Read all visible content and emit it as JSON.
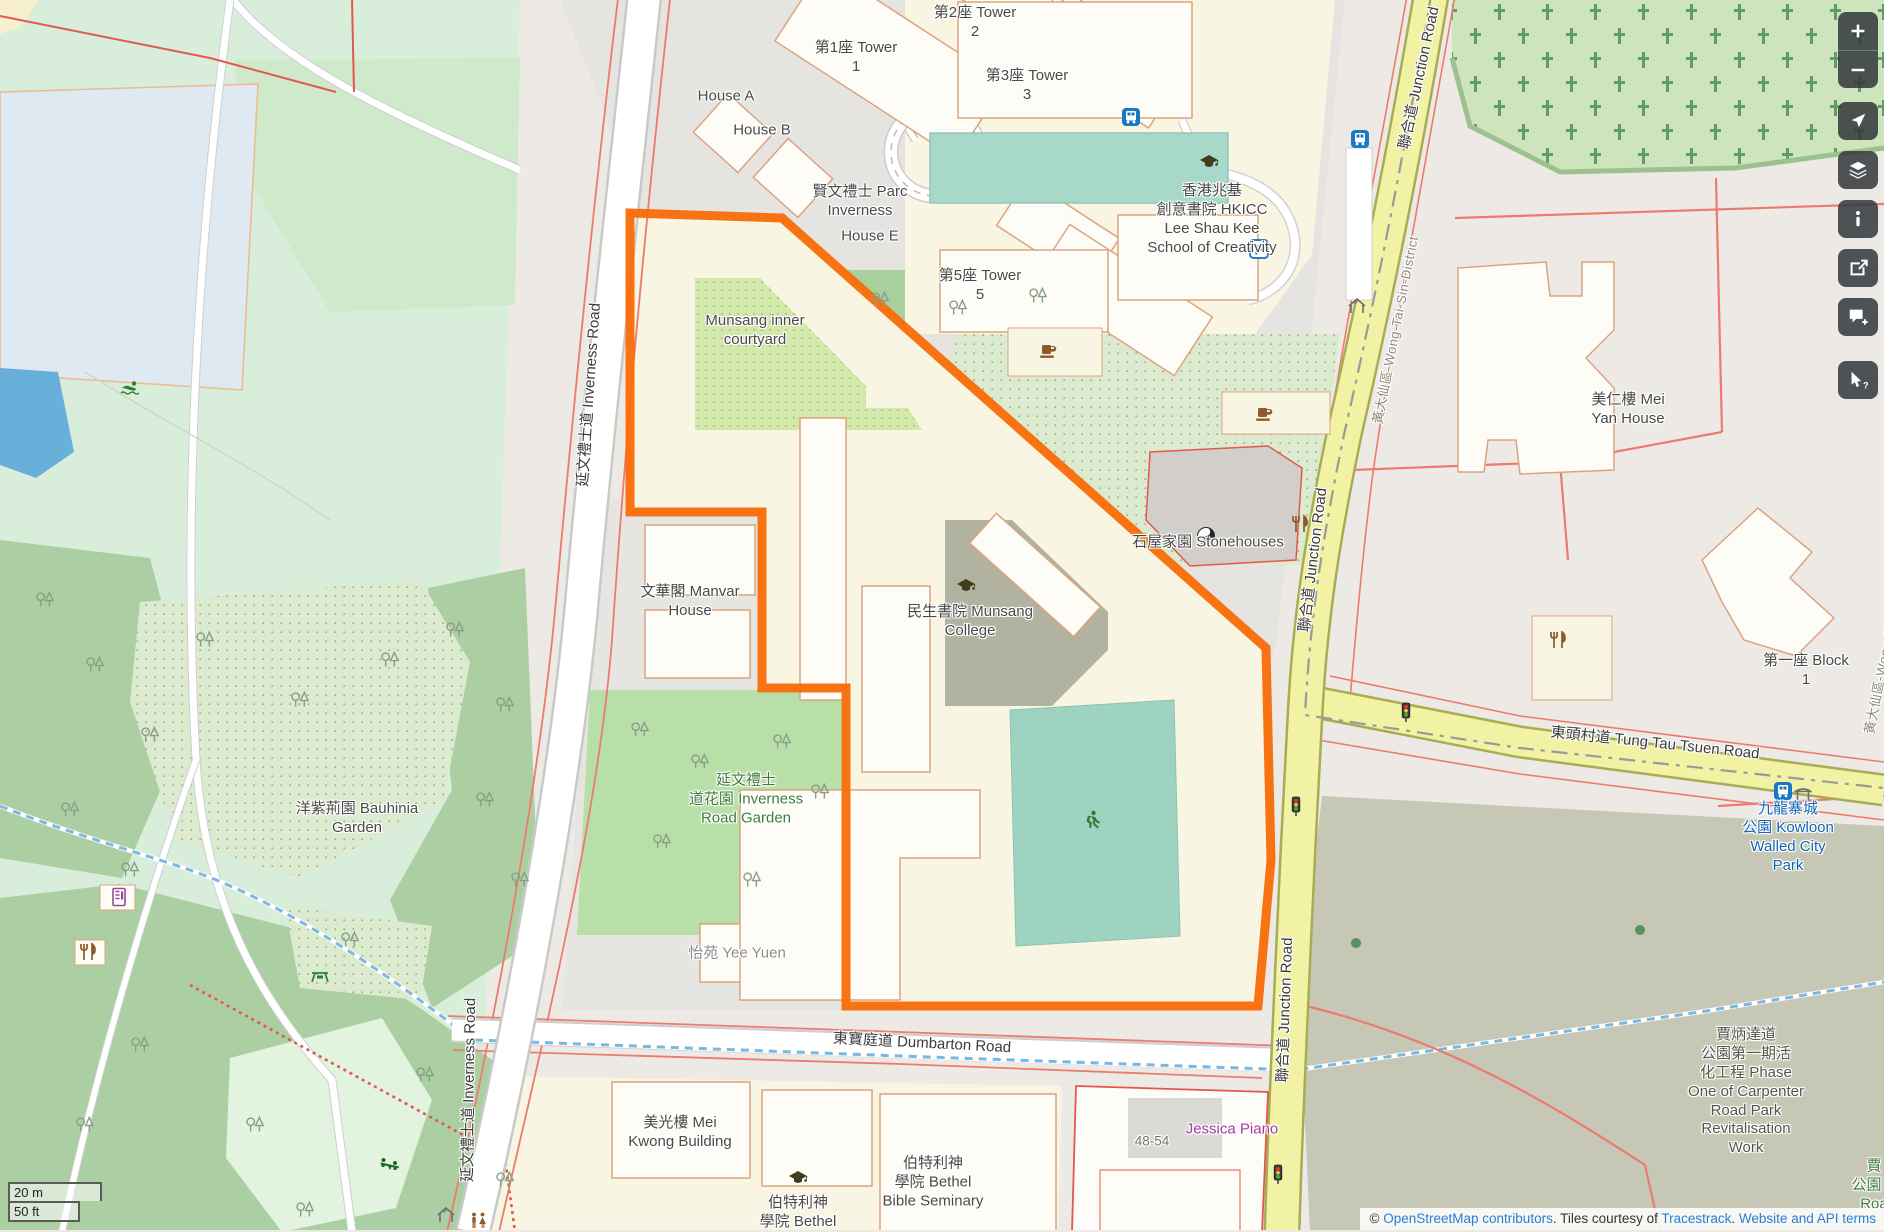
{
  "colors": {
    "highlight_orange": "#f96b07",
    "road_yellow": "#f2f2a4",
    "road_casing_olive": "#a8ad55",
    "water_blue": "#68b0da",
    "park_green": "#d8eeda",
    "wood_green": "#abcfa2",
    "school_cream": "#f8f5e2",
    "building_stroke": "#dba47e",
    "fence_red": "#e4574d",
    "attraction_blue": "#1166b3",
    "shop_purple": "#a23ca2",
    "link_blue": "#2a7cd4",
    "control_bg": "#31373a",
    "bus_blue": "#1679c2"
  },
  "scale_bar": {
    "metric": "20 m",
    "imperial": "50 ft"
  },
  "attribution": {
    "prefix": "© ",
    "link_osm": "OpenStreetMap contributors",
    "mid1": ". Tiles courtesy of ",
    "link_tiles": "Tracestrack",
    "mid2": ". ",
    "link_terms": "Website and API terms"
  },
  "controls": [
    {
      "name": "zoom-in-button",
      "icon": "plus",
      "group": "zoom"
    },
    {
      "name": "zoom-out-button",
      "icon": "minus",
      "group": "zoom"
    },
    {
      "name": "show-my-location-button",
      "icon": "locate"
    },
    {
      "name": "layers-button",
      "icon": "layers"
    },
    {
      "name": "map-key-button",
      "icon": "info"
    },
    {
      "name": "share-button",
      "icon": "share"
    },
    {
      "name": "add-note-button",
      "icon": "note"
    },
    {
      "name": "query-features-button",
      "icon": "query"
    }
  ],
  "map": {
    "labels": [
      {
        "name": "label-tower-2",
        "lines": [
          "第2座 Tower",
          "2"
        ],
        "x": 975,
        "y": 23
      },
      {
        "name": "label-tower-1",
        "lines": [
          "第1座 Tower",
          "1"
        ],
        "x": 856,
        "y": 58
      },
      {
        "name": "label-tower-3",
        "lines": [
          "第3座 Tower",
          "3"
        ],
        "x": 1027,
        "y": 86
      },
      {
        "name": "label-house-a",
        "lines": [
          "House A"
        ],
        "x": 726,
        "y": 97
      },
      {
        "name": "label-house-b",
        "lines": [
          "House B"
        ],
        "x": 762,
        "y": 131
      },
      {
        "name": "label-parc-inverness",
        "lines": [
          "賢文禮士 Parc",
          "Inverness"
        ],
        "x": 860,
        "y": 202
      },
      {
        "name": "label-house-e",
        "lines": [
          "House E"
        ],
        "x": 870,
        "y": 237
      },
      {
        "name": "label-tower-5",
        "lines": [
          "第5座 Tower",
          "5"
        ],
        "x": 980,
        "y": 286
      },
      {
        "name": "label-hkicc",
        "lines": [
          "香港兆基",
          "創意書院 HKICC",
          "Lee Shau Kee",
          "School of Creativity"
        ],
        "x": 1212,
        "y": 220
      },
      {
        "name": "label-munsang-courtyard",
        "lines": [
          "Munsang inner",
          "courtyard"
        ],
        "x": 755,
        "y": 331
      },
      {
        "name": "label-manvar-house",
        "lines": [
          "文華閣 Manvar",
          "House"
        ],
        "x": 690,
        "y": 602
      },
      {
        "name": "label-munsang-college",
        "lines": [
          "民生書院 Munsang",
          "College"
        ],
        "x": 970,
        "y": 622
      },
      {
        "name": "label-stonehouses",
        "lines": [
          "石屋家園 Stonehouses"
        ],
        "x": 1208,
        "y": 543
      },
      {
        "name": "label-mei-yan-house",
        "lines": [
          "美仁樓 Mei",
          "Yan House"
        ],
        "x": 1628,
        "y": 410
      },
      {
        "name": "label-inverness-road-garden",
        "type": "park",
        "lines": [
          "延文禮士",
          "道花園 Inverness",
          "Road Garden"
        ],
        "x": 746,
        "y": 800
      },
      {
        "name": "label-bauhinia-garden",
        "lines": [
          "洋紫荊園 Bauhinia",
          "Garden"
        ],
        "x": 357,
        "y": 819
      },
      {
        "name": "label-yee-yuen",
        "type": "muted",
        "lines": [
          "怡苑 Yee Yuen"
        ],
        "x": 737,
        "y": 954
      },
      {
        "name": "label-block-1",
        "lines": [
          "第一座 Block",
          "1"
        ],
        "x": 1806,
        "y": 671
      },
      {
        "name": "label-kowloon-walled-city-park",
        "type": "attraction",
        "lines": [
          "九龍寨城",
          "公園 Kowloon",
          "Walled City",
          "Park"
        ],
        "x": 1788,
        "y": 838
      },
      {
        "name": "label-jessica-piano",
        "type": "shop",
        "lines": [
          "Jessica Piano"
        ],
        "x": 1232,
        "y": 1130
      },
      {
        "name": "label-housenumber",
        "type": "housenum",
        "lines": [
          "48-54"
        ],
        "x": 1152,
        "y": 1141
      },
      {
        "name": "label-mei-kwong-building",
        "lines": [
          "美光樓 Mei",
          "Kwong Building"
        ],
        "x": 680,
        "y": 1133
      },
      {
        "name": "label-bethel-bible-seminary",
        "lines": [
          "伯特利神",
          "學院 Bethel",
          "Bible Seminary"
        ],
        "x": 933,
        "y": 1183
      },
      {
        "name": "label-bethel-seminary-poi",
        "lines": [
          "伯特利神",
          "學院 Bethel"
        ],
        "x": 798,
        "y": 1213
      },
      {
        "name": "label-carpenter-road-park-works",
        "type": "construction",
        "lines": [
          "賈炳達道",
          "公園第一期活",
          "化工程 Phase",
          "One of Carpenter",
          "Road Park",
          "Revitalisation",
          "Work"
        ],
        "x": 1746,
        "y": 1092
      },
      {
        "name": "label-carpenter-road-park",
        "type": "park",
        "lines": [
          "賈",
          "公園 C",
          "Roa"
        ],
        "x": 1874,
        "y": 1186
      },
      {
        "name": "label-inverness-road-north",
        "type": "road",
        "text": "延文禮士道 Inverness Road",
        "x": 590,
        "y": 395,
        "rot": -86
      },
      {
        "name": "label-inverness-road-south",
        "type": "road",
        "text": "延文禮士道 Inverness Road",
        "x": 470,
        "y": 1090,
        "rot": -89
      },
      {
        "name": "label-junction-road-north",
        "type": "road",
        "text": "聯合道 Junction Road",
        "x": 1420,
        "y": 78,
        "rot": -78
      },
      {
        "name": "label-junction-road-mid",
        "type": "road",
        "text": "聯合道 Junction Road",
        "x": 1314,
        "y": 560,
        "rot": -83
      },
      {
        "name": "label-junction-road-south",
        "type": "road",
        "text": "聯合道 Junction Road",
        "x": 1286,
        "y": 1010,
        "rot": -88
      },
      {
        "name": "label-tung-tau-tsuen-road",
        "type": "road",
        "text": "東頭村道 Tung Tau Tsuen Road",
        "x": 1655,
        "y": 744,
        "rot": 6
      },
      {
        "name": "label-dumbarton-road",
        "type": "road",
        "text": "東寶庭道 Dumbarton Road",
        "x": 922,
        "y": 1044,
        "rot": 3
      },
      {
        "name": "label-wong-tai-sin-district-boundary",
        "type": "boundary",
        "text": "黃大仙區-Wong-Tai-Sin-District",
        "x": 1396,
        "y": 330,
        "rot": -79
      },
      {
        "name": "label-wong-tai-sin-district-boundary-2",
        "type": "boundary",
        "text": "黃大仙區-Wong-Tai-Sin-District",
        "x": 1888,
        "y": 640,
        "rot": -79
      }
    ],
    "icons": [
      {
        "t": "gradcap",
        "x": 966,
        "y": 586
      },
      {
        "t": "gradcap",
        "x": 1209,
        "y": 162
      },
      {
        "t": "gradcap",
        "x": 798,
        "y": 1178
      },
      {
        "t": "cafe",
        "x": 1048,
        "y": 351
      },
      {
        "t": "cafe",
        "x": 1264,
        "y": 414
      },
      {
        "t": "restaurant",
        "x": 1300,
        "y": 524
      },
      {
        "t": "restaurant",
        "x": 1558,
        "y": 640
      },
      {
        "t": "restaurant",
        "x": 88,
        "y": 952
      },
      {
        "t": "yinyang",
        "x": 1206,
        "y": 536
      },
      {
        "t": "parking",
        "x": 1259,
        "y": 249
      },
      {
        "t": "bus",
        "x": 1131,
        "y": 117
      },
      {
        "t": "bus",
        "x": 1360,
        "y": 139
      },
      {
        "t": "bus",
        "x": 1783,
        "y": 791
      },
      {
        "t": "shelter",
        "x": 1357,
        "y": 306
      },
      {
        "t": "shelter",
        "x": 446,
        "y": 1215
      },
      {
        "t": "gate",
        "x": 1803,
        "y": 794
      },
      {
        "t": "toilets",
        "x": 478,
        "y": 1221
      },
      {
        "t": "swimmer",
        "x": 130,
        "y": 388
      },
      {
        "t": "runner",
        "x": 1092,
        "y": 820
      },
      {
        "t": "playground",
        "x": 390,
        "y": 1164
      },
      {
        "t": "picnic",
        "x": 320,
        "y": 976
      },
      {
        "t": "trafficlight",
        "x": 1406,
        "y": 712
      },
      {
        "t": "trafficlight",
        "x": 1296,
        "y": 806
      },
      {
        "t": "trafficlight",
        "x": 1278,
        "y": 1174
      },
      {
        "t": "treedot",
        "x": 1356,
        "y": 943
      },
      {
        "t": "treedot",
        "x": 1640,
        "y": 930
      },
      {
        "t": "vending",
        "x": 119,
        "y": 897
      }
    ],
    "trees": [
      [
        45,
        600
      ],
      [
        95,
        665
      ],
      [
        150,
        735
      ],
      [
        70,
        810
      ],
      [
        130,
        870
      ],
      [
        455,
        630
      ],
      [
        505,
        705
      ],
      [
        485,
        800
      ],
      [
        520,
        880
      ],
      [
        350,
        940
      ],
      [
        140,
        1045
      ],
      [
        85,
        1125
      ],
      [
        255,
        1125
      ],
      [
        425,
        1075
      ],
      [
        505,
        1180
      ],
      [
        305,
        1210
      ],
      [
        640,
        730
      ],
      [
        700,
        762
      ],
      [
        782,
        742
      ],
      [
        820,
        792
      ],
      [
        662,
        842
      ],
      [
        752,
        880
      ],
      [
        880,
        300
      ],
      [
        958,
        308
      ],
      [
        1038,
        296
      ],
      [
        205,
        640
      ],
      [
        300,
        700
      ],
      [
        390,
        660
      ]
    ]
  }
}
